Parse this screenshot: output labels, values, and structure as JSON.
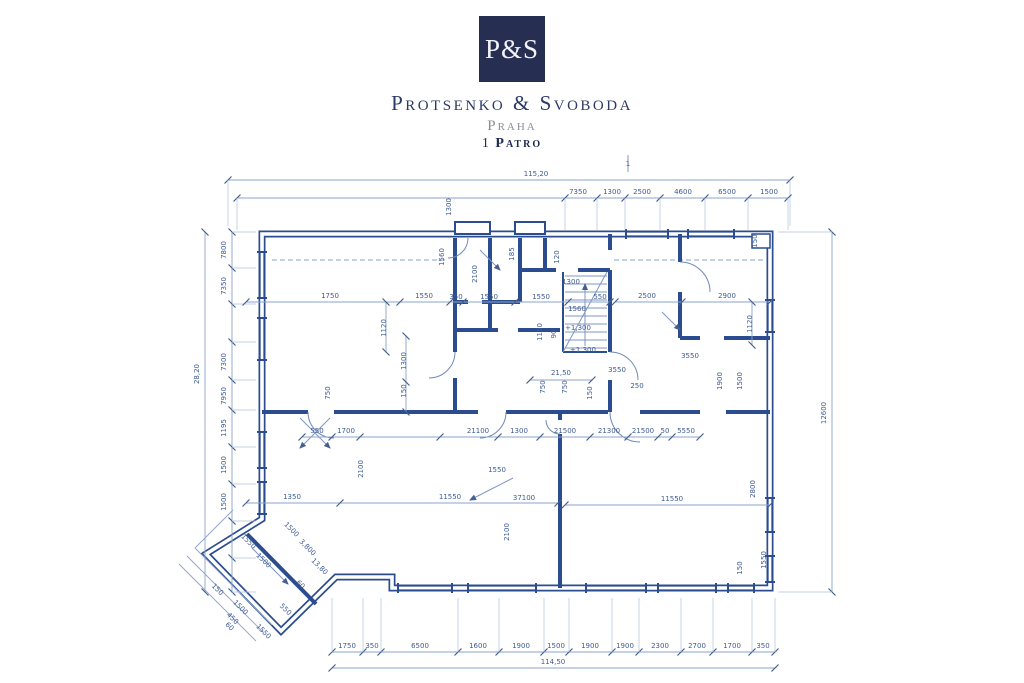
{
  "brand": {
    "monogram": "P&S",
    "name": "Protsenko & Svoboda",
    "city": "Praha",
    "floor_number": "1",
    "floor_label": "Patro"
  },
  "plan": {
    "chains": [
      {
        "name": "top-total",
        "orient": "h",
        "x1": 228,
        "x2": 790,
        "y": 180,
        "ticks": [
          228,
          790
        ],
        "ext": 226,
        "labels": [
          {
            "t": "115,20",
            "x": 536,
            "y": 176
          }
        ]
      },
      {
        "name": "top-chain",
        "orient": "h",
        "x1": 237,
        "x2": 788,
        "y": 198,
        "ticks": [
          237,
          565,
          597,
          625,
          660,
          705,
          748,
          788
        ],
        "ext": 230,
        "labels": [
          {
            "t": "7350",
            "x": 578,
            "y": 194
          },
          {
            "t": "1300",
            "x": 612,
            "y": 194
          },
          {
            "t": "2500",
            "x": 642,
            "y": 194
          },
          {
            "t": "4600",
            "x": 683,
            "y": 194
          },
          {
            "t": "6500",
            "x": 727,
            "y": 194
          },
          {
            "t": "1500",
            "x": 769,
            "y": 194
          }
        ]
      },
      {
        "name": "left-total",
        "orient": "v",
        "x": 205,
        "y1": 232,
        "y2": 592,
        "ticks": [
          232,
          592
        ],
        "labels": [
          {
            "t": "28,20",
            "x": 199,
            "y": 374,
            "r": -90
          }
        ]
      },
      {
        "name": "left-chain",
        "orient": "v",
        "x": 232,
        "y1": 232,
        "y2": 592,
        "ticks": [
          232,
          268,
          304,
          342,
          380,
          410,
          447,
          484,
          521,
          558,
          592
        ],
        "ext": 256,
        "labels": [
          {
            "t": "7800",
            "x": 226,
            "y": 250,
            "r": -90
          },
          {
            "t": "7350",
            "x": 226,
            "y": 286,
            "r": -90
          },
          {
            "t": "7300",
            "x": 226,
            "y": 362,
            "r": -90
          },
          {
            "t": "7950",
            "x": 226,
            "y": 396,
            "r": -90
          },
          {
            "t": "1195",
            "x": 226,
            "y": 428,
            "r": -90
          },
          {
            "t": "1500",
            "x": 226,
            "y": 465,
            "r": -90
          },
          {
            "t": "1500",
            "x": 226,
            "y": 502,
            "r": -90
          }
        ]
      },
      {
        "name": "right-chain",
        "orient": "v",
        "x": 832,
        "y1": 232,
        "y2": 592,
        "ticks": [
          232,
          592
        ],
        "ext": 778,
        "labels": [
          {
            "t": "12600",
            "x": 826,
            "y": 413,
            "r": -90
          }
        ]
      },
      {
        "name": "bottom-chain",
        "orient": "h",
        "x1": 332,
        "x2": 775,
        "y": 652,
        "ticks": [
          332,
          363,
          381,
          458,
          499,
          544,
          569,
          612,
          639,
          681,
          713,
          752,
          775
        ],
        "ext": 598,
        "labels": [
          {
            "t": "1750",
            "x": 347,
            "y": 648
          },
          {
            "t": "350",
            "x": 372,
            "y": 648
          },
          {
            "t": "6500",
            "x": 420,
            "y": 648
          },
          {
            "t": "1600",
            "x": 478,
            "y": 648
          },
          {
            "t": "1900",
            "x": 521,
            "y": 648
          },
          {
            "t": "1500",
            "x": 556,
            "y": 648
          },
          {
            "t": "1900",
            "x": 590,
            "y": 648
          },
          {
            "t": "1900",
            "x": 625,
            "y": 648
          },
          {
            "t": "2300",
            "x": 660,
            "y": 648
          },
          {
            "t": "2700",
            "x": 697,
            "y": 648
          },
          {
            "t": "1700",
            "x": 732,
            "y": 648
          },
          {
            "t": "350",
            "x": 763,
            "y": 648
          }
        ]
      },
      {
        "name": "bottom-total",
        "orient": "h",
        "x1": 332,
        "x2": 775,
        "y": 668,
        "ticks": [
          332,
          775
        ],
        "labels": [
          {
            "t": "114,50",
            "x": 553,
            "y": 664
          }
        ]
      },
      {
        "name": "room-left-top",
        "orient": "h",
        "x1": 246,
        "x2": 610,
        "y": 302,
        "ticks": [
          246,
          400,
          450,
          463,
          515,
          568,
          610
        ],
        "labels": [
          {
            "t": "1750",
            "x": 330,
            "y": 298
          },
          {
            "t": "1550",
            "x": 424,
            "y": 298
          },
          {
            "t": "350",
            "x": 456,
            "y": 299
          },
          {
            "t": "1550",
            "x": 489,
            "y": 299
          },
          {
            "t": "1550",
            "x": 541,
            "y": 299
          },
          {
            "t": "550",
            "x": 600,
            "y": 299
          }
        ]
      },
      {
        "name": "room-right-top",
        "orient": "h",
        "x1": 615,
        "x2": 770,
        "y": 302,
        "ticks": [
          615,
          682,
          770
        ],
        "labels": [
          {
            "t": "2500",
            "x": 647,
            "y": 298
          },
          {
            "t": "2900",
            "x": 727,
            "y": 298
          }
        ]
      },
      {
        "name": "mid-chain",
        "orient": "h",
        "x1": 302,
        "x2": 700,
        "y": 437,
        "ticks": [
          302,
          332,
          360,
          440,
          498,
          540,
          590,
          628,
          658,
          672,
          700
        ],
        "labels": [
          {
            "t": "550",
            "x": 317,
            "y": 433
          },
          {
            "t": "1700",
            "x": 346,
            "y": 433
          },
          {
            "t": "21100",
            "x": 478,
            "y": 433
          },
          {
            "t": "1300",
            "x": 519,
            "y": 433
          },
          {
            "t": "21500",
            "x": 565,
            "y": 433
          },
          {
            "t": "21300",
            "x": 609,
            "y": 433
          },
          {
            "t": "21500",
            "x": 643,
            "y": 433
          },
          {
            "t": "50",
            "x": 665,
            "y": 433
          },
          {
            "t": "5550",
            "x": 686,
            "y": 433
          }
        ]
      },
      {
        "name": "room-left-bottom",
        "orient": "h",
        "x1": 246,
        "x2": 558,
        "y": 503,
        "ticks": [
          246,
          340,
          558
        ],
        "labels": [
          {
            "t": "1350",
            "x": 292,
            "y": 499
          },
          {
            "t": "11550",
            "x": 450,
            "y": 499
          }
        ]
      },
      {
        "name": "room-right-bottom",
        "orient": "h",
        "x1": 565,
        "x2": 770,
        "y": 505,
        "ticks": [
          565,
          770
        ],
        "labels": [
          {
            "t": "11550",
            "x": 672,
            "y": 501
          }
        ]
      },
      {
        "name": "stair-width",
        "orient": "h",
        "x1": 530,
        "x2": 592,
        "y": 380,
        "ticks": [
          530,
          592
        ],
        "labels": []
      },
      {
        "name": "v-aux-1",
        "orient": "v",
        "x": 406,
        "y1": 336,
        "y2": 412,
        "ticks": [
          336,
          382,
          412
        ],
        "labels": []
      },
      {
        "name": "v-aux-2",
        "orient": "v",
        "x": 386,
        "y1": 302,
        "y2": 352,
        "ticks": [
          302,
          352
        ],
        "labels": []
      },
      {
        "name": "v-aux-3",
        "orient": "v",
        "x": 752,
        "y1": 302,
        "y2": 345,
        "ticks": [
          302,
          345
        ],
        "labels": []
      }
    ],
    "labels": [
      {
        "t": "1",
        "x": 628,
        "y": 166
      },
      {
        "t": "1300",
        "x": 451,
        "y": 207,
        "r": -90
      },
      {
        "t": "1560",
        "x": 444,
        "y": 257,
        "r": -90
      },
      {
        "t": "185",
        "x": 514,
        "y": 254,
        "r": -90
      },
      {
        "t": "120",
        "x": 559,
        "y": 257,
        "r": -90
      },
      {
        "t": "2100",
        "x": 477,
        "y": 274,
        "r": -90
      },
      {
        "t": "150",
        "x": 757,
        "y": 241,
        "r": -90
      },
      {
        "t": "1300",
        "x": 571,
        "y": 284
      },
      {
        "t": "1560",
        "x": 577,
        "y": 311
      },
      {
        "t": "1120",
        "x": 386,
        "y": 328,
        "r": -90
      },
      {
        "t": "1120",
        "x": 752,
        "y": 324,
        "r": -90
      },
      {
        "t": "1150",
        "x": 542,
        "y": 332,
        "r": -90
      },
      {
        "t": "90",
        "x": 556,
        "y": 334,
        "r": -90
      },
      {
        "t": "1300",
        "x": 406,
        "y": 361,
        "r": -90
      },
      {
        "t": "150",
        "x": 406,
        "y": 391,
        "r": -90
      },
      {
        "t": "+1,300",
        "x": 578,
        "y": 330
      },
      {
        "t": "+1,300",
        "x": 583,
        "y": 352
      },
      {
        "t": "21,50",
        "x": 561,
        "y": 375
      },
      {
        "t": "3550",
        "x": 617,
        "y": 372
      },
      {
        "t": "3550",
        "x": 690,
        "y": 358
      },
      {
        "t": "750",
        "x": 545,
        "y": 387,
        "r": -90
      },
      {
        "t": "750",
        "x": 567,
        "y": 387,
        "r": -90
      },
      {
        "t": "150",
        "x": 592,
        "y": 393,
        "r": -90
      },
      {
        "t": "250",
        "x": 637,
        "y": 388
      },
      {
        "t": "1900",
        "x": 722,
        "y": 381,
        "r": -90
      },
      {
        "t": "1500",
        "x": 742,
        "y": 381,
        "r": -90
      },
      {
        "t": "750",
        "x": 330,
        "y": 393,
        "r": -90
      },
      {
        "t": "2100",
        "x": 363,
        "y": 469,
        "r": -90
      },
      {
        "t": "1550",
        "x": 497,
        "y": 472
      },
      {
        "t": "37100",
        "x": 524,
        "y": 500
      },
      {
        "t": "2100",
        "x": 509,
        "y": 532,
        "r": -90
      },
      {
        "t": "2800",
        "x": 755,
        "y": 489,
        "r": -90
      },
      {
        "t": "150",
        "x": 742,
        "y": 568,
        "r": -90
      },
      {
        "t": "1550",
        "x": 766,
        "y": 560,
        "r": -90
      },
      {
        "t": "1550",
        "x": 247,
        "y": 543,
        "r": 45
      },
      {
        "t": "1500",
        "x": 290,
        "y": 531,
        "r": 45
      },
      {
        "t": "1500",
        "x": 262,
        "y": 562,
        "r": 45
      },
      {
        "t": "3,800",
        "x": 306,
        "y": 549,
        "r": 45
      },
      {
        "t": "13,80",
        "x": 318,
        "y": 568,
        "r": 45
      },
      {
        "t": "150",
        "x": 216,
        "y": 591,
        "r": 45
      },
      {
        "t": "1500",
        "x": 239,
        "y": 609,
        "r": 45
      },
      {
        "t": "450",
        "x": 231,
        "y": 620,
        "r": 45
      },
      {
        "t": "60",
        "x": 228,
        "y": 628,
        "r": 45
      },
      {
        "t": "1550",
        "x": 262,
        "y": 633,
        "r": 45
      },
      {
        "t": "550",
        "x": 284,
        "y": 611,
        "r": 45
      },
      {
        "t": "60",
        "x": 299,
        "y": 586,
        "r": 45
      }
    ]
  }
}
